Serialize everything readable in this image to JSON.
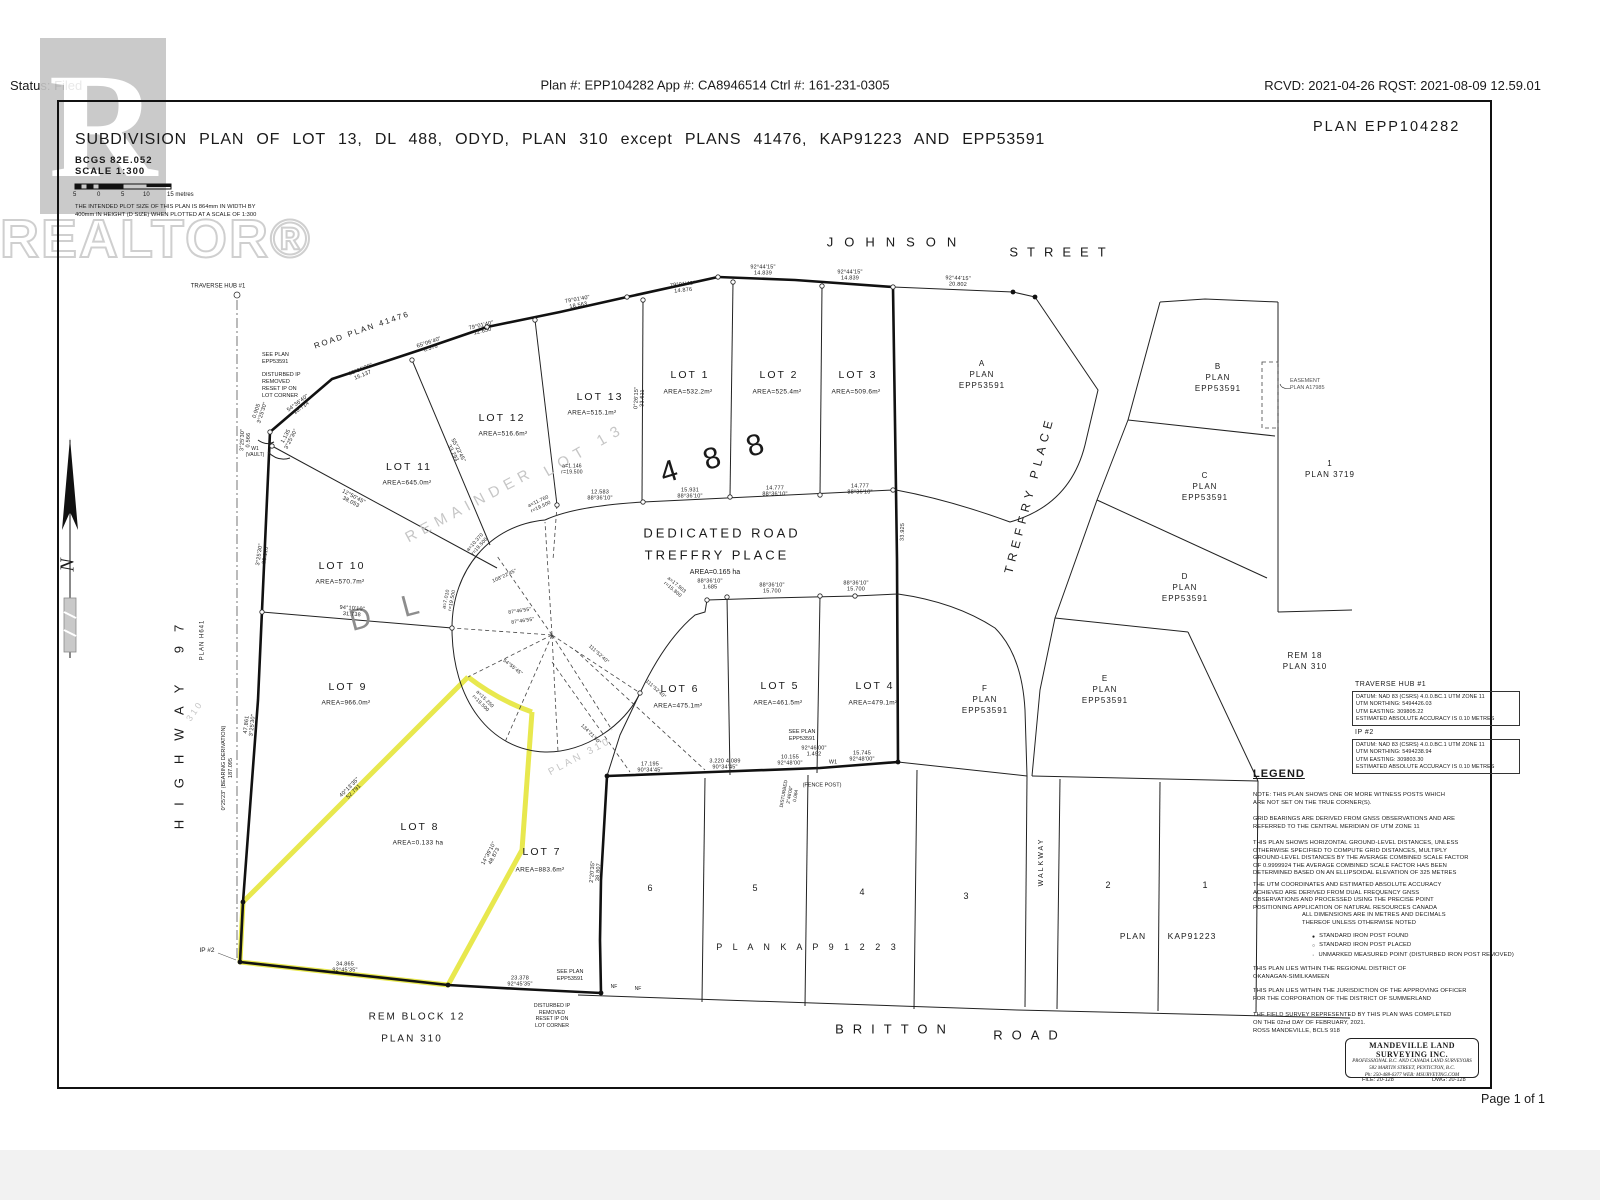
{
  "colors": {
    "line": "#1a1a1a",
    "highlight": "#e8e84e",
    "ghost": "#c6c6c6",
    "paper": "#ffffff"
  },
  "header": {
    "status": "Status: Filed",
    "plan_info": "Plan #: EPP104282 App #: CA8946514  Ctrl #: 161-231-0305",
    "rcvd": "RCVD: 2021-04-26 RQST: 2021-08-09 12.59.01",
    "page": "Page 1 of 1"
  },
  "title_block": {
    "plan_no": "PLAN EPP104282",
    "title": "SUBDIVISION PLAN OF LOT 13, DL 488, ODYD, PLAN 310 except PLANS 41476, KAP91223 AND EPP53591",
    "bcgs": "BCGS  82E.052",
    "scale": "SCALE  1:300",
    "ticks": [
      "5",
      "0",
      "5",
      "10"
    ],
    "tend": "15 metres",
    "note": "THE INTENDED PLOT SIZE OF THIS PLAN IS 864mm IN WIDTH BY\n400mm IN HEIGHT (D SIZE) WHEN PLOTTED AT A SCALE OF 1:300"
  },
  "watermark": {
    "r": "R",
    "text": "REALTOR®"
  },
  "streets": {
    "johnson": "JOHNSON",
    "street": "STREET",
    "treffry": "TREFFRY PLACE",
    "britton": "BRITTON",
    "road": "ROAD",
    "walkway": "WALKWAY",
    "highway": "HIGHWAY  97",
    "hplan": "PLAN H641",
    "roadplan": "ROAD PLAN 41476",
    "north": "N"
  },
  "dedicated": {
    "l1": "DEDICATED ROAD",
    "l2": "TREFFRY PLACE",
    "l3": "AREA=0.165 ha"
  },
  "ghost": {
    "rem": "REMAINDER",
    "lot13": "LOT 13",
    "dl": "D L",
    "d488": "4 8 8",
    "plan310": "PLAN 310",
    "p310": "3 1 0"
  },
  "lots": {
    "lot1": {
      "n": "LOT 1",
      "a": "AREA=532.2m²"
    },
    "lot2": {
      "n": "LOT 2",
      "a": "AREA=525.4m²"
    },
    "lot3": {
      "n": "LOT 3",
      "a": "AREA=509.6m²"
    },
    "lot4": {
      "n": "LOT 4",
      "a": "AREA=479.1m²"
    },
    "lot5": {
      "n": "LOT 5",
      "a": "AREA=461.5m²"
    },
    "lot6": {
      "n": "LOT 6",
      "a": "AREA=475.1m²"
    },
    "lot7": {
      "n": "LOT 7",
      "a": "AREA=883.6m²"
    },
    "lot8": {
      "n": "LOT 8",
      "a": "AREA=0.133 ha"
    },
    "lot9": {
      "n": "LOT 9",
      "a": "AREA=966.0m²"
    },
    "lot10": {
      "n": "LOT 10",
      "a": "AREA=570.7m²"
    },
    "lot11": {
      "n": "LOT 11",
      "a": "AREA=645.0m²"
    },
    "lot12": {
      "n": "LOT 12",
      "a": "AREA=516.6m²"
    },
    "lot13": {
      "n": "LOT 13",
      "a": "AREA=515.1m²"
    }
  },
  "parcels": {
    "a": "A\nPLAN\nEPP53591",
    "b": "B\nPLAN\nEPP53591",
    "c": "C\nPLAN\nEPP53591",
    "d": "D\nPLAN\nEPP53591",
    "e": "E\nPLAN\nEPP53591",
    "f": "F\nPLAN\nEPP53591",
    "p3719": "1\nPLAN 3719",
    "ease": "EASEMENT\nPLAN A17985",
    "rem18": "REM 18\nPLAN 310",
    "remblk": "REM BLOCK 12",
    "remplan": "PLAN 310",
    "k6": "6",
    "k5": "5",
    "k4": "4",
    "k3": "3",
    "k2": "2",
    "k1": "1",
    "kspread": "P L A N      K A P 9 1 2 2 3",
    "kplan": "PLAN",
    "kno": "KAP91223"
  },
  "notes": {
    "hub": "TRAVERSE HUB #1",
    "brg": "0°25'23\" (BEARING DERIVATION)\n187.095",
    "ip2": "IP #2",
    "see1": "SEE PLAN\nEPP53591",
    "dist1": "DISTURBED IP\nREMOVED\nRESET IP ON\nLOT CORNER",
    "w1v": "W1\n(VAULT)",
    "see2": "SEE PLAN\nEPP53591",
    "dist2": "DISTURBED\n2°46'00\"\n0.084",
    "fence": "(FENCE POST)",
    "w1": "W1",
    "see3": "SEE PLAN\nEPP53591",
    "dist3": "DISTURBED IP\nREMOVED\nRESET IP ON\nLOT CORNER",
    "nf": "NF"
  },
  "dims": {
    "j1": "92°44'15\"\n14.839",
    "j2": "92°44'15\"\n14.839",
    "j3": "92°44'15\"\n20.802",
    "r1": "79°01'40\"\n14.876",
    "r2": "79°01'40\"\n18.563",
    "r3": "79°01'40\"\n12.650",
    "r4": "65°06'40\"\n6.576",
    "r5": "63°06'30\"\n15.137",
    "r6": "54°36'40\"\n10.714",
    "k1": "12.583\n88°36'10\"",
    "k2": "15.931\n88°36'10\"",
    "k3": "14.777\n88°36'10\"",
    "k4": "14.777\n88°36'10\"",
    "m1": "88°36'10\"\n1.685",
    "m2": "88°36'10\"\n15.700",
    "m3": "88°36'10\"\n15.700",
    "b1": "17.195\n90°34'45\"",
    "b2": "3.220  4.089\n90°34'45\"",
    "b3": "10.155\n92°48'00\"",
    "b4": "15.745\n92°48'00\"",
    "c1": "34.865\n92°45'35\"",
    "c2": "23.378\n92°45'35\"",
    "c3": "40°13'35\"\n52.791",
    "c4": "14°39'10\"\n48.873",
    "c5": "2°20'35\"\n38.807",
    "c6": "3°25'30\"\n28.113",
    "c7": "47.861\n3°25'30\"",
    "c8": "94°10'10\"\n31.738",
    "c9": "12°50'45\"\n38.053",
    "c10": "55°22'45\"\n33.293",
    "c11": "0°26'15\"\n33.611",
    "c12": "33.925",
    "c13": "0.905\n3°25'30\"",
    "c14": "3°25'30\"\n0.566",
    "c15": "1.135\n3°25'30\"",
    "w1": "92°46'00\"\n1.492",
    "a1": "a=1.146\nr=19.500",
    "a2": "a=11.760\nr=19.500",
    "a3": "a=10.370\nr=19.500",
    "a4": "a=7.010\nr=19.500",
    "a5": "a=15.250\nr=19.500",
    "a6": "a=17.903\nr=15.800",
    "g1": "108°22'45\"",
    "g2": "87°46'55\"",
    "g3": "87°46'55\"",
    "g4": "54°55'45\"",
    "g5": "111°52'40\"",
    "g6": "111°52'40\"",
    "g7": "134°21'50\""
  },
  "legend": {
    "hub_title": "TRAVERSE HUB #1",
    "hub_lines": [
      "DATUM: NAD 83 (CSRS) 4.0.0.BC.1 UTM ZONE 11",
      "UTM NORTHING: 5494426.03",
      "UTM EASTING: 309805.22",
      "ESTIMATED ABSOLUTE ACCURACY IS 0.10 METRES"
    ],
    "ip_title": "IP #2",
    "ip_lines": [
      "DATUM: NAD 83 (CSRS) 4.0.0.BC.1 UTM ZONE 11",
      "UTM NORTHING: 5494238.94",
      "UTM EASTING: 309803.30",
      "ESTIMATED ABSOLUTE ACCURACY IS 0.10 METRES"
    ],
    "title": "LEGEND",
    "n1": "NOTE: THIS PLAN SHOWS ONE OR MORE WITNESS POSTS WHICH ARE NOT SET ON THE TRUE CORNER(S).",
    "n2": "GRID BEARINGS ARE DERIVED FROM GNSS OBSERVATIONS AND ARE REFERRED TO THE CENTRAL MERIDIAN OF UTM ZONE 11",
    "n3": "THIS PLAN SHOWS HORIZONTAL GROUND-LEVEL DISTANCES, UNLESS OTHERWISE SPECIFIED TO COMPUTE GRID DISTANCES, MULTIPLY GROUND-LEVEL DISTANCES BY THE AVERAGE COMBINED SCALE FACTOR OF 0.9999924 THE AVERAGE COMBINED SCALE FACTOR HAS BEEN DETERMINED BASED ON AN ELLIPSOIDAL ELEVATION OF 325 METRES",
    "n4": "THE UTM COORDINATES AND ESTIMATED ABSOLUTE ACCURACY ACHIEVED ARE DERIVED FROM DUAL FREQUENCY GNSS OBSERVATIONS AND PROCESSED USING THE PRECISE POINT POSITIONING APPLICATION OF NATURAL RESOURCES CANADA",
    "n5": "ALL DIMENSIONS ARE IN METRES AND DECIMALS THEREOF UNLESS OTHERWISE NOTED",
    "syms": [
      {
        "g": "●",
        "t": "STANDARD IRON POST FOUND"
      },
      {
        "g": "○",
        "t": "STANDARD IRON POST PLACED"
      },
      {
        "g": "·",
        "t": "UNMARKED MEASURED POINT (DISTURBED IRON POST REMOVED)"
      }
    ],
    "n6": "THIS PLAN LIES WITHIN THE REGIONAL DISTRICT OF OKANAGAN-SIMILKAMEEN",
    "n7": "THIS PLAN LIES WITHIN THE JURISDICTION OF THE APPROVING OFFICER FOR THE CORPORATION OF THE DISTRICT OF SUMMERLAND",
    "n8": "THE FIELD SURVEY REPRESENTED BY THIS PLAN WAS COMPLETED ON THE 02nd DAY OF FEBRUARY, 2021.",
    "n9": "ROSS MANDEVILLE, BCLS 918"
  },
  "firm": {
    "name": "MANDEVILLE LAND SURVEYING INC.",
    "l2": "PROFESSIONAL B.C. AND CANADA LAND SURVEYORS",
    "l3": "582 MARTIN STREET, PENTICTON, B.C.",
    "l4": "Ph: 250-488-6377      WEB: MSURVEYING.COM",
    "file": "FILE: 20-128",
    "dwg": "DWG: 20-128"
  }
}
